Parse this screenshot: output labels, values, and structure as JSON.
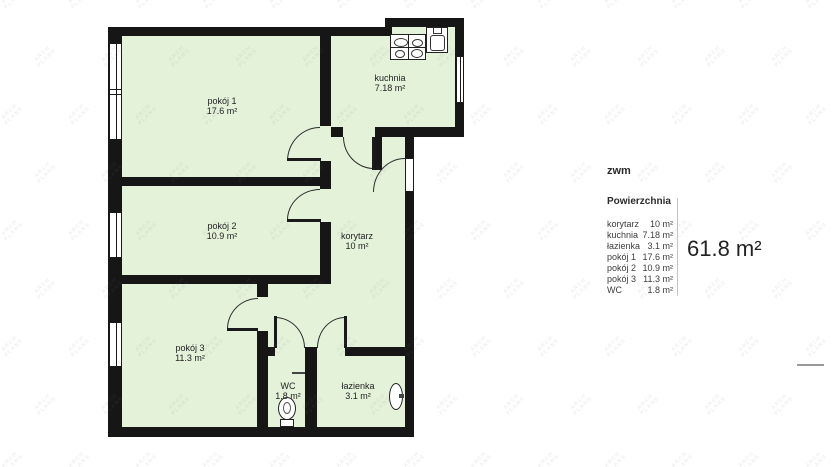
{
  "watermark": {
    "line1": "ARCH",
    "line2": "PLANS"
  },
  "floorplan": {
    "rooms": [
      {
        "id": "pokoj-1",
        "label": "pokój 1",
        "area": "17.6 m²"
      },
      {
        "id": "kuchnia",
        "label": "kuchnia",
        "area": "7.18 m²"
      },
      {
        "id": "pokoj-2",
        "label": "pokój 2",
        "area": "10.9 m²"
      },
      {
        "id": "korytarz",
        "label": "korytarz",
        "area": "10 m²"
      },
      {
        "id": "pokoj-3",
        "label": "pokój 3",
        "area": "11.3 m²"
      },
      {
        "id": "wc",
        "label": "WC",
        "area": "1.8 m²"
      },
      {
        "id": "lazienka",
        "label": "łazienka",
        "area": "3.1 m²"
      }
    ],
    "icons": [
      "stove-icon",
      "kitchen-sink-icon",
      "toilet-icon",
      "bathroom-sink-icon",
      "window",
      "door-arc"
    ]
  },
  "legend": {
    "title": "zwm",
    "section_title": "Powierzchnia",
    "rows": [
      {
        "label": "korytarz",
        "value": "10 m²"
      },
      {
        "label": "kuchnia",
        "value": "7.18 m²"
      },
      {
        "label": "łazienka",
        "value": "3.1 m²"
      },
      {
        "label": "pokój 1",
        "value": "17.6 m²"
      },
      {
        "label": "pokój 2",
        "value": "10.9 m²"
      },
      {
        "label": "pokój 3",
        "value": "11.3 m²"
      },
      {
        "label": "WC",
        "value": "1.8 m²"
      }
    ],
    "total": "61.8 m²"
  },
  "colors": {
    "room_fill": "#e4f2da",
    "wall": "#161616",
    "watermark": "#ededed",
    "divider": "#c4c4c4"
  }
}
